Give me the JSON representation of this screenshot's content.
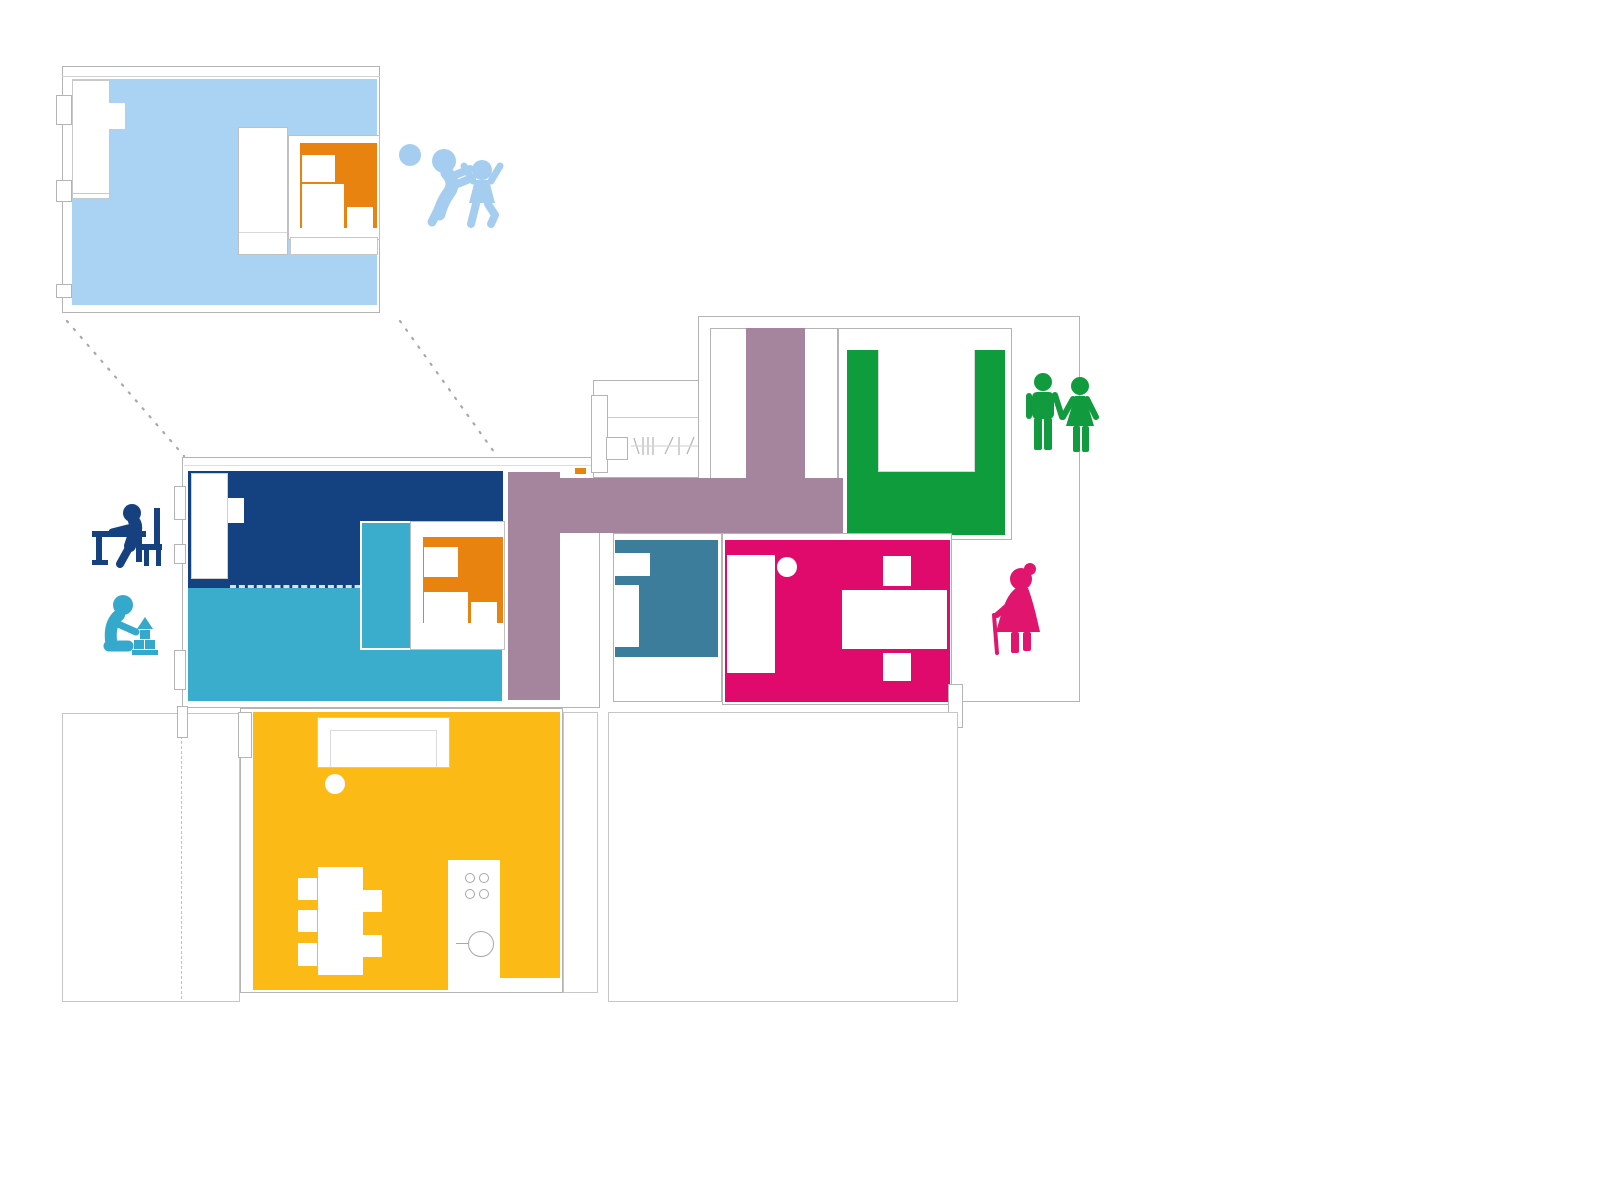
{
  "palette": {
    "background": "#FFFFFF",
    "wall_outline": "#B4B4B4",
    "room_light_blue": "#A9D2F3",
    "room_navy": "#14417F",
    "room_cyan": "#39ADCB",
    "room_mauve": "#A5849D",
    "room_green": "#0E9C3D",
    "room_teal": "#3C7D9B",
    "room_magenta": "#DF0A6B",
    "room_yellow": "#FBBA16",
    "furniture_orange": "#E8830F",
    "figure_light_blue": "#A5CDF0",
    "figure_navy": "#15417E",
    "figure_cyan": "#35A9CB",
    "figure_green": "#129B3E",
    "figure_pink": "#E0156E"
  },
  "diagram": {
    "type": "architectural-floor-plan",
    "description_semantic": "color-coded room plan with occupant pictograms, enlarged children-room detail connected by dotted lines",
    "detail_room": {
      "name": "children-room-enlarged-detail",
      "color_key": "room_light_blue",
      "furniture": [
        "wardrobe",
        "bed",
        "orange-desk-shelf-unit",
        "bench"
      ]
    },
    "rooms": [
      {
        "name": "bedroom-dark-blue",
        "color_key": "room_navy",
        "furniture": [
          "wardrobe"
        ]
      },
      {
        "name": "children-room-cyan",
        "color_key": "room_cyan",
        "furniture": [
          "bed",
          "orange-desk-shelf-unit"
        ]
      },
      {
        "name": "hallway-t-shaped",
        "color_key": "room_mauve",
        "furniture": [
          "stairs",
          "entry-door"
        ]
      },
      {
        "name": "bedroom-green",
        "color_key": "room_green",
        "furniture": [
          "double-bed"
        ]
      },
      {
        "name": "bathroom-teal",
        "color_key": "room_teal",
        "furniture": [
          "fixtures"
        ]
      },
      {
        "name": "bedroom-magenta",
        "color_key": "room_magenta",
        "furniture": [
          "bed",
          "lamp",
          "table-with-chairs"
        ]
      },
      {
        "name": "living-kitchen-yellow",
        "color_key": "room_yellow",
        "furniture": [
          "sofa",
          "lamp",
          "dining-table-with-chairs",
          "kitchen-counter-stove-sink"
        ]
      },
      {
        "name": "terrace-left",
        "color_key": "background",
        "furniture": []
      },
      {
        "name": "terrace-south",
        "color_key": "background",
        "furniture": []
      },
      {
        "name": "terrace-right",
        "color_key": "background",
        "furniture": []
      }
    ],
    "figures": [
      {
        "name": "children-playing-ball",
        "color_key": "figure_light_blue"
      },
      {
        "name": "child-at-desk",
        "color_key": "figure_navy"
      },
      {
        "name": "child-with-building-blocks",
        "color_key": "figure_cyan"
      },
      {
        "name": "couple-holding-hands",
        "color_key": "figure_green"
      },
      {
        "name": "elderly-woman-with-cane",
        "color_key": "figure_pink"
      }
    ]
  }
}
